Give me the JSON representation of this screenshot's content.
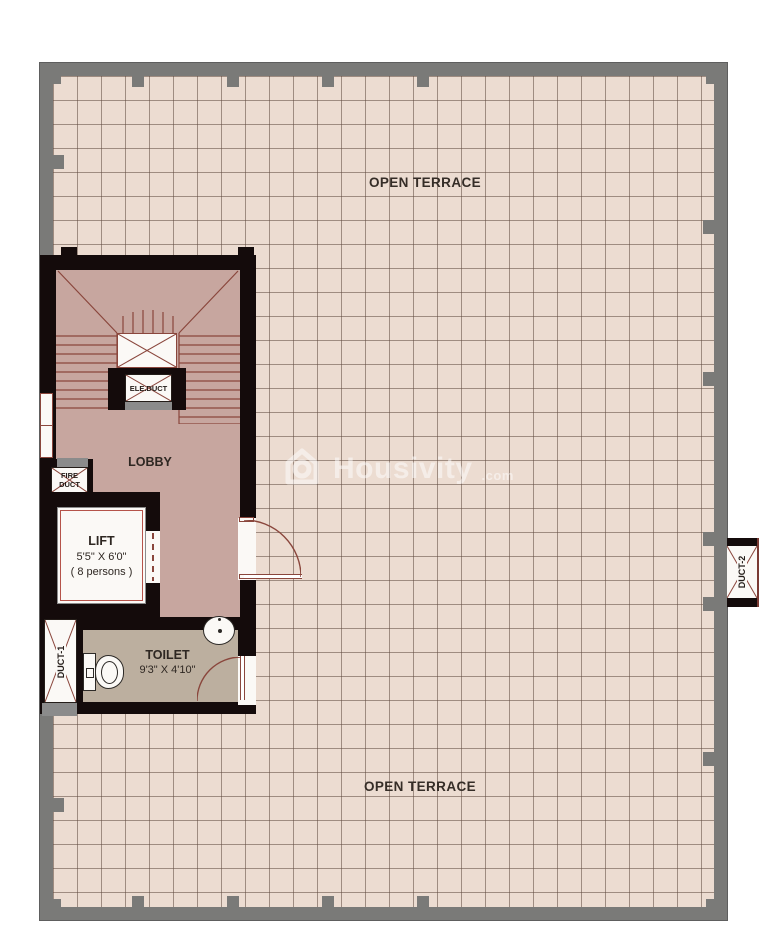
{
  "plan": {
    "title_top": "OPEN TERRACE",
    "title_bottom": "OPEN TERRACE",
    "rooms": {
      "lobby": "LOBBY",
      "lift": [
        "LIFT",
        "5'5\" X 6'0\"",
        "( 8 persons )"
      ],
      "toilet": [
        "TOILET",
        "9'3\" X 4'10\""
      ]
    },
    "ducts": {
      "ele_duct": "ELE.DUCT",
      "fire_duct": [
        "FIRE",
        "DUCT"
      ],
      "duct1": "DUCT-1",
      "duct2": "DUCT-2"
    },
    "watermark": {
      "brand": "Housivity",
      "suffix": ".com"
    },
    "colors": {
      "wall_gray": "#7a7a78",
      "wall_black": "#140b0b",
      "floor_lobby": "#c7a69f",
      "floor_terrace": "#ecdcd1",
      "floor_toilet": "#bcaf9f",
      "line_red": "#8a463c",
      "strip_gray": "#8b8b8b"
    }
  }
}
